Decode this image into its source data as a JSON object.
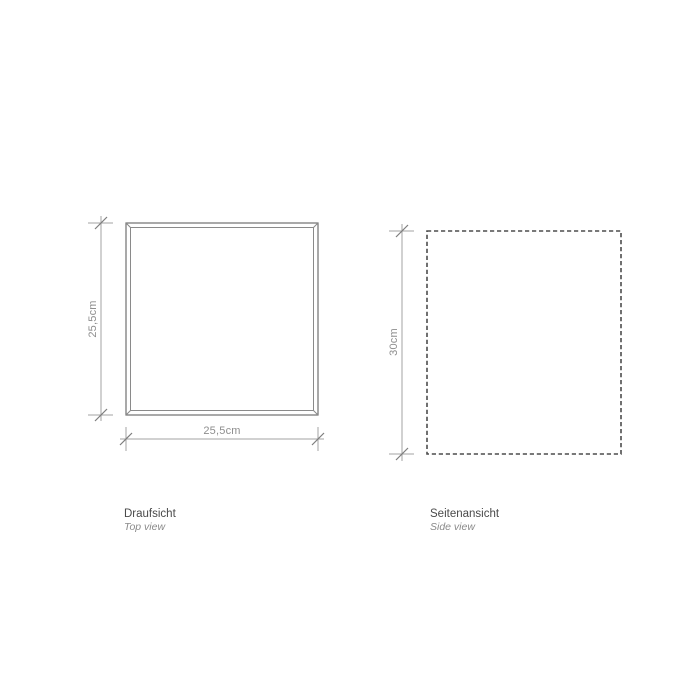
{
  "drawing": {
    "views": {
      "top": {
        "label_de": "Draufsicht",
        "label_en": "Top view",
        "width_dim": "25,5cm",
        "height_dim": "25,5cm"
      },
      "side": {
        "label_de": "Seitenansicht",
        "label_en": "Side view",
        "height_dim": "30cm"
      }
    },
    "colors": {
      "background": "#ffffff",
      "frame_outer_line": "#707070",
      "frame_inner_line": "#8a8a8a",
      "dashed_outline": "#4d4d4d",
      "dimension_line": "#a3a3a3",
      "tick_slash": "#7d7d7d",
      "dim_text": "#8e8e8e",
      "caption_de_text": "#4a4a4a",
      "caption_en_text": "#8a8a8a"
    }
  }
}
